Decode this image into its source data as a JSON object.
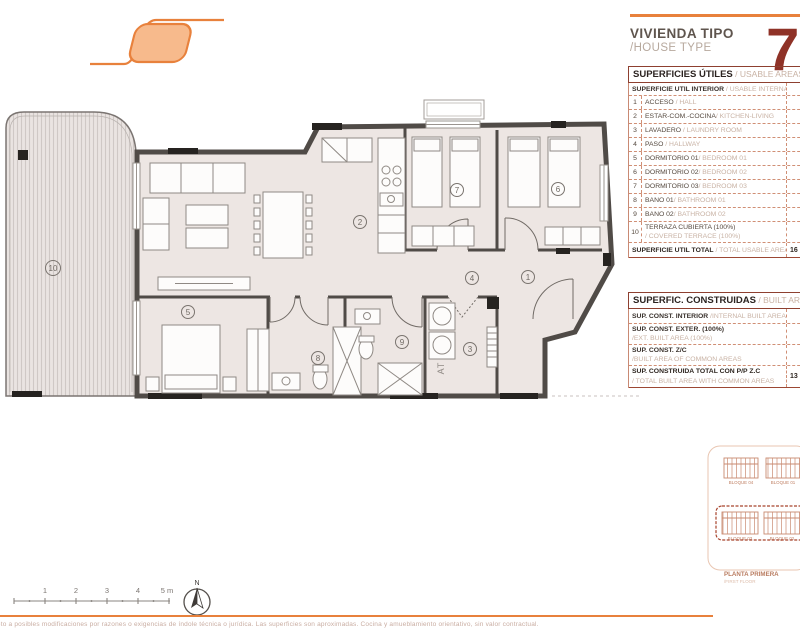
{
  "brand": {
    "title": "VIVIENDA TIPO",
    "subtitle": "/HOUSE TYPE",
    "type_number": "7"
  },
  "usable_table": {
    "title_es": "SUPERFICIES ÚTILES",
    "title_en": " / USABLE AREAS",
    "subheader_es": "SUPERFICIE ÚTIL INTERIOR",
    "subheader_en": " / USABLE INTERNAL AREA",
    "rows": [
      {
        "num": "1",
        "es": "ACCESO",
        "en": " / HALL",
        "value": ""
      },
      {
        "num": "2",
        "es": "ESTAR-COM.-COCINA",
        "en": "/ KITCHEN-LIVING",
        "value": ""
      },
      {
        "num": "3",
        "es": "LAVADERO",
        "en": " / LAUNDRY ROOM",
        "value": ""
      },
      {
        "num": "4",
        "es": "PASO",
        "en": " / HALLWAY",
        "value": ""
      },
      {
        "num": "5",
        "es": "DORMITORIO 01",
        "en": "/ BEDROOM 01",
        "value": ""
      },
      {
        "num": "6",
        "es": "DORMITORIO 02",
        "en": "/ BEDROOM 02",
        "value": ""
      },
      {
        "num": "7",
        "es": "DORMITORIO 03",
        "en": "/ BEDROOM 03",
        "value": ""
      },
      {
        "num": "8",
        "es": "BAÑO 01",
        "en": "/ BATHROOM 01",
        "value": ""
      },
      {
        "num": "9",
        "es": "BAÑO 02",
        "en": "/ BATHROOM 02",
        "value": ""
      },
      {
        "num": "10",
        "es": "TERRAZA CUBIERTA (100%)",
        "en": "/ COVERED TERRACE (100%)",
        "value": ""
      }
    ],
    "total_es": "SUPERFICIE ÚTIL TOTAL",
    "total_en": " / TOTAL USABLE AREA",
    "total_value": "16"
  },
  "built_table": {
    "title_es": "SUPERFIC. CONSTRUIDAS",
    "title_en": " / BUILT AREAS",
    "rows": [
      {
        "es": "SUP. CONST. INTERIOR",
        "en": " /INTERNAL BUILT AREA",
        "en2": "",
        "value": ""
      },
      {
        "es": "SUP. CONST. EXTER. (100%)",
        "en": "",
        "en2": "/EXT. BUILT AREA (100%)",
        "value": ""
      },
      {
        "es": "SUP. CONST. Z/C",
        "en": "",
        "en2": "/BUILT AREA OF COMMON AREAS",
        "value": ""
      }
    ],
    "total_es": "SUP. CONSTRUIDA TOTAL CON P/P Z.C",
    "total_en2": "/ TOTAL BUILT AREA WITH COMMON AREAS",
    "total_value": "13"
  },
  "plan": {
    "numbers": [
      "1",
      "2",
      "3",
      "4",
      "5",
      "6",
      "7",
      "8",
      "9",
      "10"
    ],
    "laundry_label": "AT",
    "north": "N"
  },
  "scalebar": {
    "labels": [
      "1",
      "2",
      "3",
      "4",
      "5 m"
    ]
  },
  "keyplan": {
    "blocks": [
      "BLOQUE 04",
      "BLOQUE 01",
      "BLOQUE 03",
      "BLOQUE 02"
    ],
    "floor_es": "PLANTA PRIMERA",
    "floor_en": "/FIRST FLOOR"
  },
  "footer": {
    "disclaimer": "sujeto a posibles modificaciones por razones o exigencias de índole técnica o jurídica. Las superficies son aproximadas. Cocina y amueblamiento orientativo, sin valor contractual."
  },
  "colors": {
    "accent_orange": "#E8813C",
    "logo_fill": "#F7BA8C",
    "brand_red": "#8F3227",
    "table_line": "#D08F75",
    "wall": "#504B47",
    "floor": "#EDE6E3",
    "keyplan_line": "#C98A70",
    "keyplan_dash": "#A8432C"
  }
}
